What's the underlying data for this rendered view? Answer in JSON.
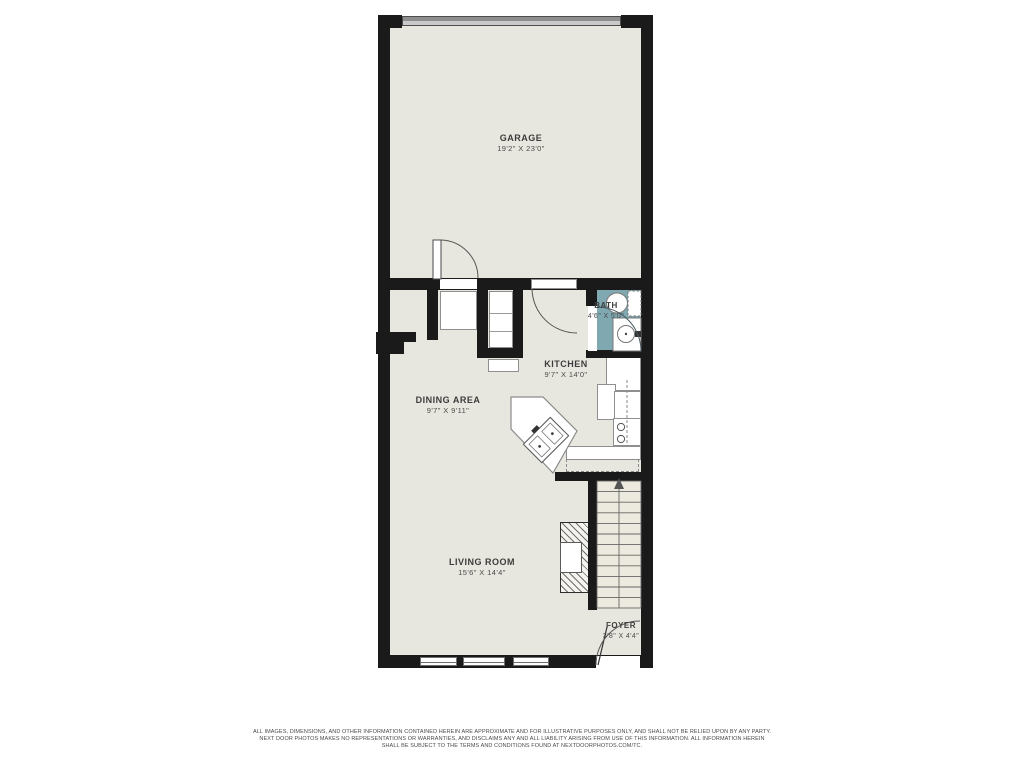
{
  "rooms": {
    "garage": {
      "name": "GARAGE",
      "dims": "19'2\" X 23'0\""
    },
    "dining": {
      "name": "DINING AREA",
      "dims": "9'7\" X 9'11\""
    },
    "kitchen": {
      "name": "KITCHEN",
      "dims": "9'7\" X 14'0\""
    },
    "bath": {
      "name": "BATH",
      "dims": "4'6\" X 5'0\""
    },
    "living": {
      "name": "LIVING ROOM",
      "dims": "15'6\" X 14'4\""
    },
    "foyer": {
      "name": "FOYER",
      "dims": "3'8\" X 4'4\""
    }
  },
  "colors": {
    "wall": "#1a1a1a",
    "floor": "#e8e7df",
    "bath_floor": "#7fa8b1",
    "garage_door_dark": "#8e8e8e",
    "garage_door_light": "#c9c9c9"
  },
  "disclaimer": {
    "line1": "ALL IMAGES, DIMENSIONS, AND OTHER INFORMATION CONTAINED HEREIN ARE APPROXIMATE AND FOR ILLUSTRATIVE PURPOSES ONLY, AND SHALL NOT BE RELIED UPON BY ANY PARTY.",
    "line2": "NEXT DOOR PHOTOS MAKES NO REPRESENTATIONS OR WARRANTIES, AND DISCLAIMS ANY AND ALL LIABILITY ARISING FROM USE OF THIS INFORMATION. ALL INFORMATION HEREIN",
    "line3": "SHALL BE SUBJECT TO THE TERMS AND CONDITIONS FOUND AT NEXTDOORPHOTOS.COM/TC."
  }
}
